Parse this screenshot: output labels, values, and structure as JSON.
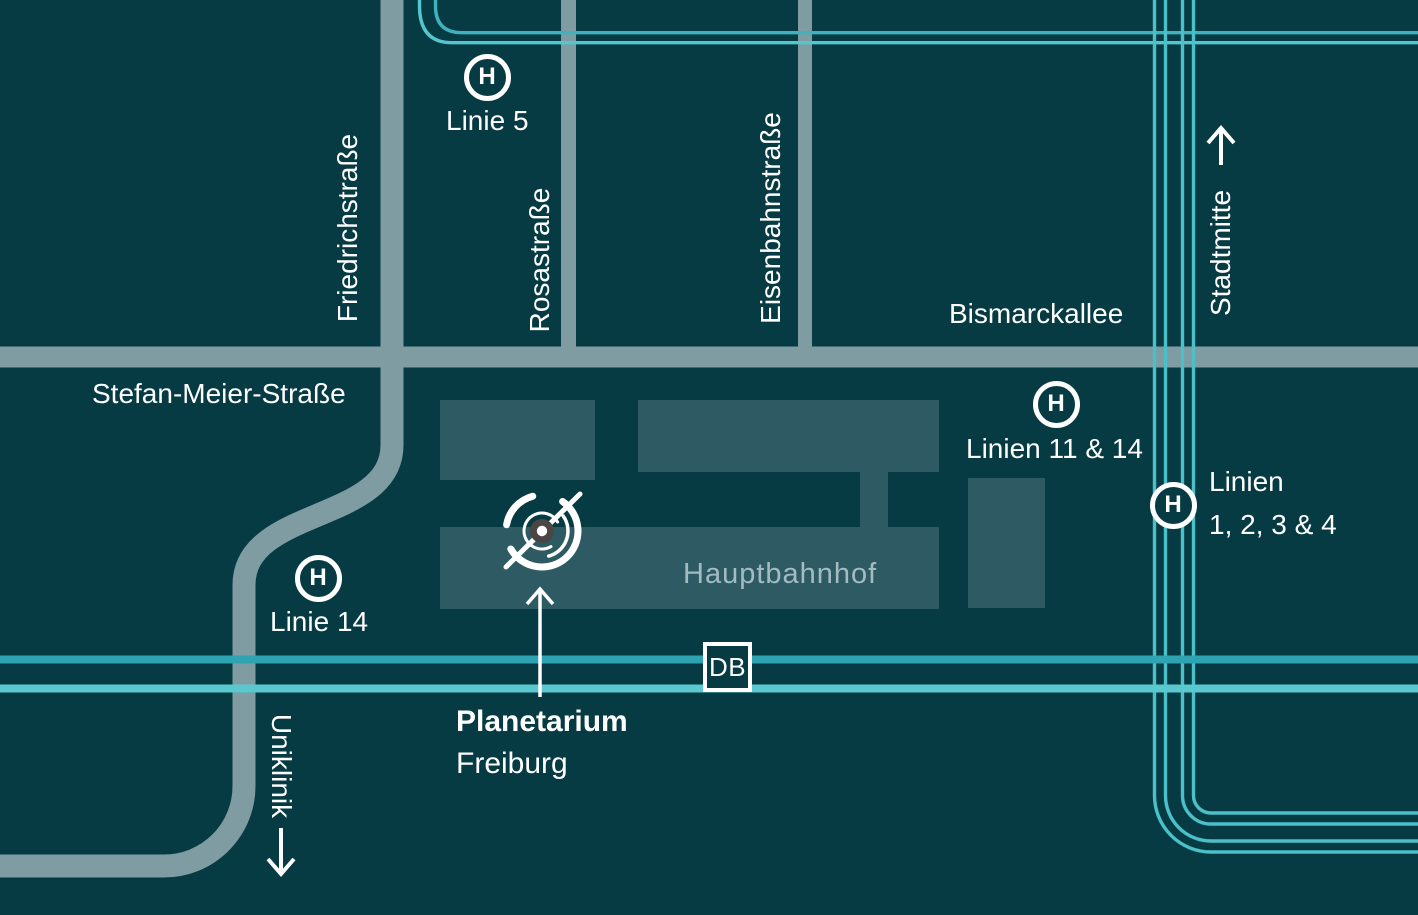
{
  "colors": {
    "background": "#063b44",
    "building": "#2e5a64",
    "road": "#7f9ca3",
    "rail_dark": "#2ea3b1",
    "rail_light": "#5ac8cf",
    "tram_line": "#4cc0c8",
    "tram_line_dark": "#3fb2be",
    "tram_line_light": "#55c6cd",
    "label_text": "#ffffff",
    "station_text": "#a3bcc2",
    "planetarium_icon_center": "#4a4644"
  },
  "streets": {
    "friedrichstrasse": "Friedrichstraße",
    "rosastrasse": "Rosastraße",
    "eisenbahnstrasse": "Eisenbahnstraße",
    "bismarckallee": "Bismarckallee",
    "stefan_meier_strasse": "Stefan-Meier-Straße"
  },
  "directions": {
    "stadtmitte": "Stadtmitte",
    "uniklinik": "Uniklinik"
  },
  "stops": {
    "symbol": "H",
    "linie5": "Linie 5",
    "linie14": "Linie 14",
    "linien11_14": "Linien 11 & 14",
    "linien1234_line1": "Linien",
    "linien1234_line2": "1, 2, 3 & 4"
  },
  "station": {
    "name": "Hauptbahnhof",
    "db": "DB"
  },
  "poi": {
    "name": "Planetarium",
    "city": "Freiburg"
  }
}
